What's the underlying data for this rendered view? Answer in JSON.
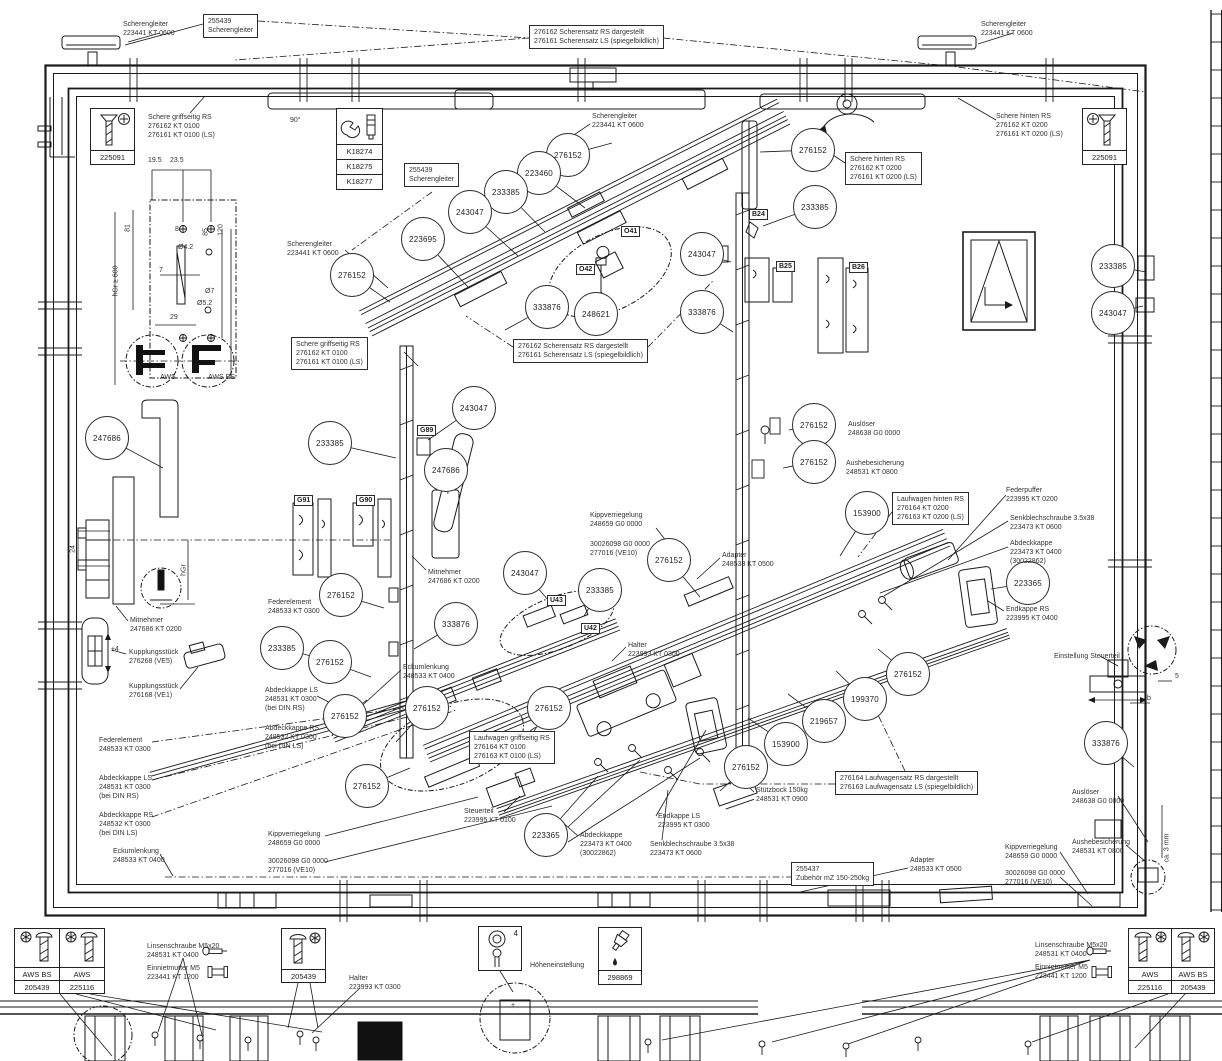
{
  "diagram": {
    "callouts": [
      {
        "n": "276152",
        "x": 568,
        "y": 155,
        "tx": 612,
        "ty": 143
      },
      {
        "n": "223460",
        "x": 539,
        "y": 173,
        "tx": 585,
        "ty": 208
      },
      {
        "n": "233385",
        "x": 506,
        "y": 192,
        "tx": 545,
        "ty": 232
      },
      {
        "n": "243047",
        "x": 470,
        "y": 212,
        "tx": 518,
        "ty": 256
      },
      {
        "n": "223695",
        "x": 423,
        "y": 239,
        "tx": 468,
        "ty": 287
      },
      {
        "n": "276152",
        "x": 352,
        "y": 275,
        "tx": 390,
        "ty": 302
      },
      {
        "n": "333876",
        "x": 547,
        "y": 307,
        "tx": 505,
        "ty": 330
      },
      {
        "n": "248621",
        "x": 596,
        "y": 314,
        "tx": 602,
        "ty": 292
      },
      {
        "n": "276152",
        "x": 813,
        "y": 150,
        "tx": 760,
        "ty": 152
      },
      {
        "n": "233385",
        "x": 815,
        "y": 207,
        "tx": 763,
        "ty": 226
      },
      {
        "n": "243047",
        "x": 702,
        "y": 254,
        "tx": 731,
        "ty": 262
      },
      {
        "n": "333876",
        "x": 702,
        "y": 312,
        "tx": 733,
        "ty": 332
      },
      {
        "n": "233385",
        "x": 1113,
        "y": 266,
        "tx": 1146,
        "ty": 272
      },
      {
        "n": "243047",
        "x": 1113,
        "y": 313,
        "tx": 1143,
        "ty": 306
      },
      {
        "n": "243047",
        "x": 474,
        "y": 408,
        "tx": 428,
        "ty": 440
      },
      {
        "n": "233385",
        "x": 330,
        "y": 443,
        "tx": 396,
        "ty": 458
      },
      {
        "n": "247686",
        "x": 446,
        "y": 470,
        "tx": 448,
        "ty": 494
      },
      {
        "n": "247686",
        "x": 107,
        "y": 438,
        "tx": 163,
        "ty": 468
      },
      {
        "n": "276152",
        "x": 814,
        "y": 425,
        "tx": 789,
        "ty": 430
      },
      {
        "n": "276152",
        "x": 814,
        "y": 462,
        "tx": 783,
        "ty": 468
      },
      {
        "n": "153900",
        "x": 867,
        "y": 513,
        "tx": 840,
        "ty": 556
      },
      {
        "n": "243047",
        "x": 525,
        "y": 573,
        "tx": 549,
        "ty": 601
      },
      {
        "n": "233385",
        "x": 600,
        "y": 590,
        "tx": 584,
        "ty": 616
      },
      {
        "n": "276152",
        "x": 669,
        "y": 560,
        "tx": 700,
        "ty": 597
      },
      {
        "n": "333876",
        "x": 456,
        "y": 624,
        "tx": 414,
        "ty": 649
      },
      {
        "n": "276152",
        "x": 341,
        "y": 595,
        "tx": 384,
        "ty": 608
      },
      {
        "n": "233385",
        "x": 282,
        "y": 648,
        "tx": 318,
        "ty": 658
      },
      {
        "n": "276152",
        "x": 330,
        "y": 662,
        "tx": 371,
        "ty": 677
      },
      {
        "n": "276152",
        "x": 345,
        "y": 716,
        "tx": 367,
        "ty": 700
      },
      {
        "n": "276152",
        "x": 367,
        "y": 786,
        "tx": 410,
        "ty": 768
      },
      {
        "n": "276152",
        "x": 427,
        "y": 708,
        "tx": 396,
        "ty": 742
      },
      {
        "n": "276152",
        "x": 549,
        "y": 708,
        "tx": 527,
        "ty": 742
      },
      {
        "n": "223365",
        "x": 546,
        "y": 835,
        "tx": 598,
        "ty": 776
      },
      {
        "n": "223365",
        "x": 1028,
        "y": 583,
        "tx": 991,
        "ty": 589
      },
      {
        "n": "153900",
        "x": 786,
        "y": 744,
        "tx": 748,
        "ty": 718
      },
      {
        "n": "219657",
        "x": 824,
        "y": 721,
        "tx": 788,
        "ty": 694
      },
      {
        "n": "199370",
        "x": 865,
        "y": 699,
        "tx": 836,
        "ty": 671
      },
      {
        "n": "276152",
        "x": 908,
        "y": 674,
        "tx": 878,
        "ty": 649
      },
      {
        "n": "276152",
        "x": 746,
        "y": 767,
        "tx": 720,
        "ty": 791
      },
      {
        "n": "333876",
        "x": 1106,
        "y": 743,
        "tx": 1134,
        "ty": 767
      }
    ],
    "labels": [
      {
        "t": "Scherengleiter\n223441 KT 0600",
        "x": 123,
        "y": 20
      },
      {
        "t": "Scherengleiter\n223441 KT 0600",
        "x": 981,
        "y": 20
      },
      {
        "t": "Schere griffseitig RS\n276162 KT 0100\n276161 KT 0100 (LS)",
        "x": 148,
        "y": 113
      },
      {
        "t": "Schere hinten RS\n276162 KT 0200\n276161 KT 0200 (LS)",
        "x": 996,
        "y": 112
      },
      {
        "t": "Scherengleiter\n223441 KT 0600",
        "x": 592,
        "y": 112
      },
      {
        "t": "Scherengleiter\n223441 KT 0600",
        "x": 287,
        "y": 240
      },
      {
        "t": "Auslöser\n248638 G0 0000",
        "x": 848,
        "y": 420
      },
      {
        "t": "Aushebesicherung\n248531 KT 0800",
        "x": 846,
        "y": 459
      },
      {
        "t": "Federpuffer\n223995 KT 0200",
        "x": 1006,
        "y": 486
      },
      {
        "t": "Senkblechschraube 3.5x38\n223473 KT 0600",
        "x": 1010,
        "y": 514
      },
      {
        "t": "Abdeckkappe\n223473 KT 0400\n(30022862)",
        "x": 1010,
        "y": 539
      },
      {
        "t": "Endkappe RS\n223995 KT 0400",
        "x": 1006,
        "y": 605
      },
      {
        "t": "Einstellung Steuerteil",
        "x": 1054,
        "y": 652
      },
      {
        "t": "Kippverriegelung\n248659 G0 0000",
        "x": 590,
        "y": 511
      },
      {
        "t": "30026098 G0 0000\n277016 (VE10)",
        "x": 590,
        "y": 540
      },
      {
        "t": "Adapter\n248533 KT 0500",
        "x": 722,
        "y": 551
      },
      {
        "t": "Mitnehmer\n247686 KT 0200",
        "x": 428,
        "y": 568
      },
      {
        "t": "Halter\n223993 KT 0300",
        "x": 628,
        "y": 641
      },
      {
        "t": "Mitnehmer\n247686 KT 0200",
        "x": 130,
        "y": 616
      },
      {
        "t": "Kupplungsstück\n276268 (VE5)",
        "x": 129,
        "y": 648
      },
      {
        "t": "Kupplungsstück\n276168 (VE1)",
        "x": 129,
        "y": 682
      },
      {
        "t": "Federelement\n248533 KT 0300",
        "x": 268,
        "y": 598
      },
      {
        "t": "Abdeckkappe LS\n248531 KT 0300\n(bei DIN RS)",
        "x": 265,
        "y": 686
      },
      {
        "t": "Abdeckkappe RS\n248532 KT 0300\n(bei DIN LS)",
        "x": 265,
        "y": 724
      },
      {
        "t": "Federelement\n248533 KT 0300",
        "x": 99,
        "y": 736
      },
      {
        "t": "Abdeckkappe LS\n248531 KT 0300\n(bei DIN RS)",
        "x": 99,
        "y": 774
      },
      {
        "t": "Abdeckkappe RS\n248532 KT 0300\n(bei DIN LS)",
        "x": 99,
        "y": 811
      },
      {
        "t": "Eckumlenkung\n248533 KT 0400",
        "x": 113,
        "y": 847
      },
      {
        "t": "Eckumlenkung\n248533 KT 0400",
        "x": 403,
        "y": 663
      },
      {
        "t": "Steuerteil\n223995 KT 0100",
        "x": 464,
        "y": 807
      },
      {
        "t": "Abdeckkappe\n223473 KT 0400\n(30022862)",
        "x": 580,
        "y": 831
      },
      {
        "t": "Endkappe LS\n223995 KT 0300",
        "x": 658,
        "y": 812
      },
      {
        "t": "Senkblechschraube 3.5x38\n223473 KT 0600",
        "x": 650,
        "y": 840
      },
      {
        "t": "Stützbock 150kg\n248531 KT 0900",
        "x": 756,
        "y": 786
      },
      {
        "t": "Kippverriegelung\n248659 G0 0000",
        "x": 268,
        "y": 830
      },
      {
        "t": "30026098 G0 0000\n277016 (VE10)",
        "x": 268,
        "y": 857
      },
      {
        "t": "Kippverriegelung\n248659 G0 0000",
        "x": 1005,
        "y": 843
      },
      {
        "t": "Aushebesicherung\n248531 KT 0800",
        "x": 1072,
        "y": 838
      },
      {
        "t": "Auslöser\n248638 G0 0000",
        "x": 1072,
        "y": 788
      },
      {
        "t": "30026098 G0 0000\n277016 (VE10)",
        "x": 1005,
        "y": 869
      },
      {
        "t": "Adapter\n248533 KT 0500",
        "x": 910,
        "y": 856
      },
      {
        "t": "Höheneinstellung",
        "x": 530,
        "y": 961
      },
      {
        "t": "Linsenschraube M5x20\n248531 KT 0400",
        "x": 147,
        "y": 942
      },
      {
        "t": "Einnietmutter M5\n223441 KT 1200",
        "x": 147,
        "y": 964
      },
      {
        "t": "Halter\n223993 KT 0300",
        "x": 349,
        "y": 974
      },
      {
        "t": "Linsenschraube M5x20\n248531 KT 0400",
        "x": 1035,
        "y": 941
      },
      {
        "t": "Einnietmutter M5\n223441 KT 1200",
        "x": 1035,
        "y": 963
      }
    ],
    "boxes": [
      {
        "t": "255439\nScherengleiter",
        "x": 203,
        "y": 14
      },
      {
        "t": "276162 Scherensatz RS dargestellt\n276161 Scherensatz LS (spiegelbildlich)",
        "x": 529,
        "y": 25
      },
      {
        "t": "255439\nScherengleiter",
        "x": 404,
        "y": 163
      },
      {
        "t": "Schere hinten RS\n276162 KT 0200\n276161 KT 0200 (LS)",
        "x": 845,
        "y": 152
      },
      {
        "t": "Schere griffseitig RS\n276162 KT 0100\n276161 KT 0100 (LS)",
        "x": 291,
        "y": 337
      },
      {
        "t": "276162 Scherensatz RS dargestellt\n276161 Scherensatz LS (spiegelbildlich)",
        "x": 513,
        "y": 339
      },
      {
        "t": "Laufwagen hinten RS\n276164 KT 0200\n276163 KT 0200 (LS)",
        "x": 892,
        "y": 492
      },
      {
        "t": "Laufwagen griffseitig RS\n276164 KT 0100\n276163 KT 0100 (LS)",
        "x": 469,
        "y": 731
      },
      {
        "t": "276164 Laufwagensatz RS dargestellt\n276163 Laufwagensatz LS (spiegelbildlich)",
        "x": 835,
        "y": 771
      },
      {
        "t": "255437\nZubehör mZ 150-250kg",
        "x": 791,
        "y": 862
      }
    ],
    "tags": [
      {
        "t": "O41",
        "x": 621,
        "y": 226
      },
      {
        "t": "O42",
        "x": 576,
        "y": 264
      },
      {
        "t": "U43",
        "x": 547,
        "y": 595
      },
      {
        "t": "U42",
        "x": 581,
        "y": 623
      },
      {
        "t": "B24",
        "x": 749,
        "y": 209
      },
      {
        "t": "B25",
        "x": 776,
        "y": 261
      },
      {
        "t": "B26",
        "x": 849,
        "y": 262
      },
      {
        "t": "G89",
        "x": 417,
        "y": 425
      },
      {
        "t": "G91",
        "x": 294,
        "y": 495
      },
      {
        "t": "G90",
        "x": 356,
        "y": 495
      }
    ],
    "dims": [
      {
        "t": "19.5",
        "x": 148,
        "y": 157
      },
      {
        "t": "23.5",
        "x": 170,
        "y": 157
      },
      {
        "t": "81",
        "x": 128,
        "y": 228,
        "rot": 1
      },
      {
        "t": "8",
        "x": 175,
        "y": 226
      },
      {
        "t": "85",
        "x": 206,
        "y": 232,
        "rot": 1
      },
      {
        "t": "120",
        "x": 221,
        "y": 230,
        "rot": 1
      },
      {
        "t": "Ø4.2",
        "x": 178,
        "y": 244
      },
      {
        "t": "hGr ≥ 600",
        "x": 116,
        "y": 281,
        "rot": 1
      },
      {
        "t": "7",
        "x": 159,
        "y": 267
      },
      {
        "t": "Ø7",
        "x": 205,
        "y": 288
      },
      {
        "t": "Ø5.2",
        "x": 197,
        "y": 300
      },
      {
        "t": "29",
        "x": 170,
        "y": 314
      },
      {
        "t": "AWS",
        "x": 160,
        "y": 374
      },
      {
        "t": "AWS BS",
        "x": 208,
        "y": 374
      },
      {
        "t": "90°",
        "x": 290,
        "y": 117
      },
      {
        "t": "24",
        "x": 73,
        "y": 549,
        "rot": 1
      },
      {
        "t": "hGr",
        "x": 184,
        "y": 570,
        "rot": 1
      },
      {
        "t": "±4",
        "x": 111,
        "y": 646
      },
      {
        "t": "ca. 3 mm",
        "x": 1167,
        "y": 848,
        "rot": 1
      },
      {
        "t": "5",
        "x": 1175,
        "y": 673
      },
      {
        "t": "b",
        "x": 1147,
        "y": 695
      },
      {
        "t": "+",
        "x": 511,
        "y": 1002
      },
      {
        "t": "−",
        "x": 511,
        "y": 1011
      }
    ]
  },
  "legend": {
    "left_box": {
      "c1_label": "AWS BS",
      "c1_num": "205439",
      "c2_label": "AWS",
      "c2_num": "225116"
    },
    "right_box": {
      "c1_label": "AWS",
      "c1_num": "225116",
      "c2_label": "AWS BS",
      "c2_num": "205439"
    },
    "halter_box_num": "205439",
    "height_box_num": "4",
    "oil_box_num": "298869",
    "screw_box_num": "225091",
    "k_rows": [
      "K18274",
      "K18275",
      "K18277"
    ]
  }
}
